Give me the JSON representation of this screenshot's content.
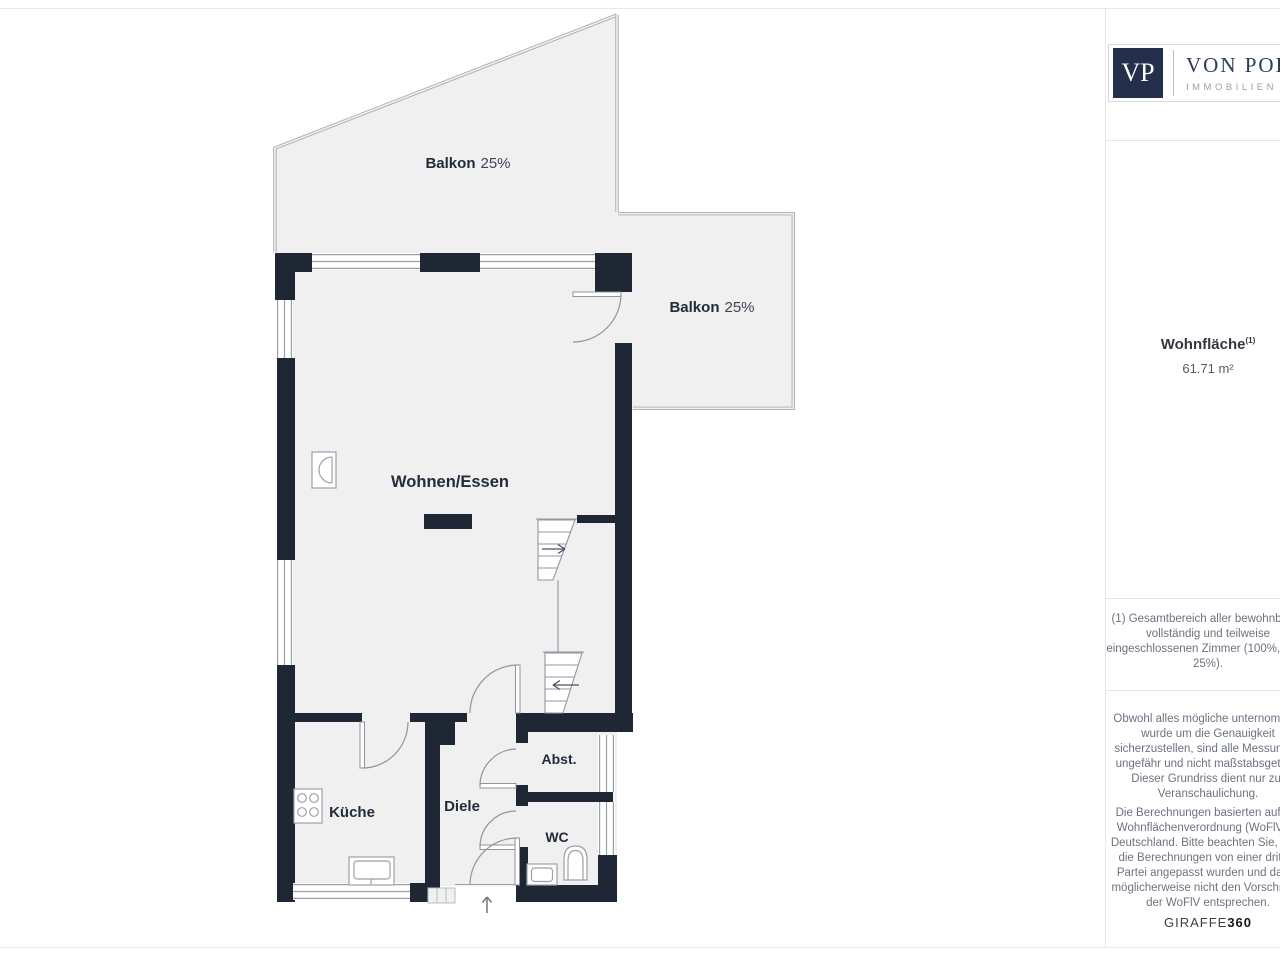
{
  "plan": {
    "balkon_top": {
      "label": "Balkon",
      "value": "25%"
    },
    "balkon_right": {
      "label": "Balkon",
      "value": "25%"
    },
    "wohnen": {
      "label": "Wohnen/Essen"
    },
    "kueche": {
      "label": "Küche"
    },
    "diele": {
      "label": "Diele"
    },
    "abst": {
      "label": "Abst."
    },
    "wc": {
      "label": "WC"
    }
  },
  "sidebar": {
    "logo": {
      "monogram": "VP",
      "brand": "VON POLL",
      "sub": "IMMOBILIEN"
    },
    "area_label": "Wohnfläche",
    "area_sup": "(1)",
    "area_value": "61.71 m²",
    "footnote": "(1) Gesamtbereich aller bewohnbaren\nvollständig und teilweise\neingeschlossenen Zimmer (100%, 50%,\n25%).",
    "disclaimer1": "Obwohl alles mögliche unternommen\nwurde um die Genauigkeit\nsicherzustellen, sind alle Messungen\nungefähr und nicht maßstabsgetreu.\nDieser Grundriss dient nur zur\nVeranschaulichung.",
    "disclaimer2": "Die Berechnungen basierten auf der\nWohnflächenverordnung (WoFlV) in\nDeutschland. Bitte beachten Sie, dass\ndie Berechnungen von einer dritten\nPartei angepasst wurden und daher\nmöglicherweise nicht den Vorschriften\nder WoFlV entsprechen.",
    "credit_regular": "GIRAFFE",
    "credit_bold": "360"
  },
  "colors": {
    "wall": "#1f2734",
    "floor": "#f0f0f1",
    "railing": "#a8adb3",
    "line": "#9ba1a8",
    "brand_navy": "#232f4b"
  }
}
